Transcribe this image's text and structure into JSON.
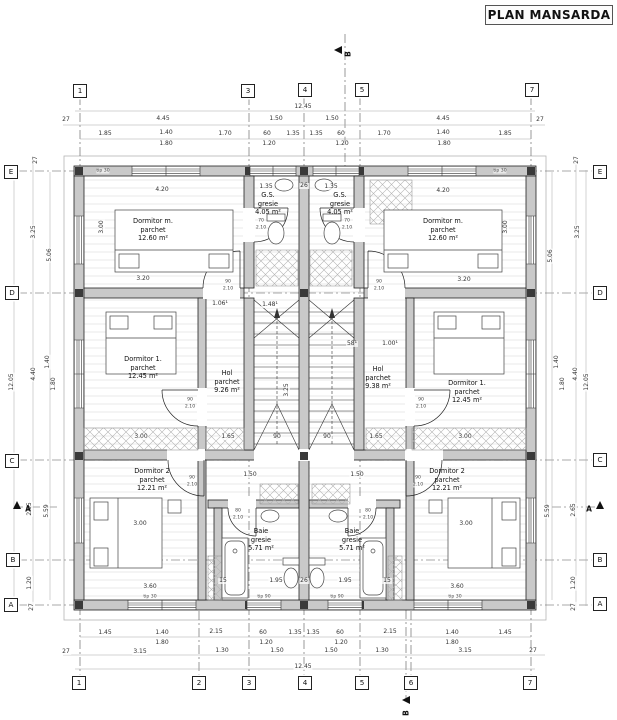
{
  "title": "PLAN MANSARDA",
  "colors": {
    "wall_fill": "#c9c9c9",
    "line": "#222222",
    "dim_line": "#999999",
    "grid_line": "#555555"
  },
  "rooms": [
    {
      "name": "Dormitor m.",
      "finish": "parchet",
      "area": "12.60 m²",
      "x": 153,
      "y": 222
    },
    {
      "name": "Dormitor m.",
      "finish": "parchet",
      "area": "12.60 m²",
      "x": 443,
      "y": 222
    },
    {
      "name": "G.S.",
      "finish": "gresie",
      "area": "4.05 m²",
      "x": 268,
      "y": 196
    },
    {
      "name": "G.S.",
      "finish": "gresie",
      "area": "4.05 m²",
      "x": 340,
      "y": 196
    },
    {
      "name": "Dormitor 1.",
      "finish": "parchet",
      "area": "12.45 m²",
      "x": 143,
      "y": 360
    },
    {
      "name": "Dormitor 1.",
      "finish": "parchet",
      "area": "12.45 m²",
      "x": 467,
      "y": 384
    },
    {
      "name": "Hol",
      "finish": "parchet",
      "area": "9.26 m²",
      "x": 227,
      "y": 374
    },
    {
      "name": "Hol",
      "finish": "parchet",
      "area": "9.38 m²",
      "x": 378,
      "y": 370
    },
    {
      "name": "Dormitor 2",
      "finish": "parchet",
      "area": "12.21 m²",
      "x": 152,
      "y": 472
    },
    {
      "name": "Dormitor 2",
      "finish": "parchet",
      "area": "12.21 m²",
      "x": 447,
      "y": 472
    },
    {
      "name": "Baie",
      "finish": "gresie",
      "area": "5.71 m²",
      "x": 261,
      "y": 532
    },
    {
      "name": "Baie",
      "finish": "gresie",
      "area": "5.71 m²",
      "x": 352,
      "y": 532
    }
  ],
  "grid_bubbles": [
    {
      "label": "1",
      "x": 80,
      "y": 91
    },
    {
      "label": "3",
      "x": 248,
      "y": 91
    },
    {
      "label": "4",
      "x": 305,
      "y": 90
    },
    {
      "label": "5",
      "x": 362,
      "y": 90
    },
    {
      "label": "7",
      "x": 532,
      "y": 90
    },
    {
      "label": "1",
      "x": 79,
      "y": 683
    },
    {
      "label": "2",
      "x": 199,
      "y": 683
    },
    {
      "label": "3",
      "x": 249,
      "y": 683
    },
    {
      "label": "4",
      "x": 305,
      "y": 683
    },
    {
      "label": "5",
      "x": 362,
      "y": 683
    },
    {
      "label": "6",
      "x": 411,
      "y": 683
    },
    {
      "label": "7",
      "x": 530,
      "y": 683
    },
    {
      "label": "E",
      "x": 11,
      "y": 172
    },
    {
      "label": "D",
      "x": 12,
      "y": 293
    },
    {
      "label": "C",
      "x": 12,
      "y": 461
    },
    {
      "label": "B",
      "x": 13,
      "y": 560
    },
    {
      "label": "A",
      "x": 11,
      "y": 605
    },
    {
      "label": "E",
      "x": 600,
      "y": 172
    },
    {
      "label": "D",
      "x": 600,
      "y": 293
    },
    {
      "label": "C",
      "x": 600,
      "y": 460
    },
    {
      "label": "B",
      "x": 600,
      "y": 560
    },
    {
      "label": "A",
      "x": 600,
      "y": 604
    }
  ],
  "section_markers": [
    {
      "label": "B",
      "tx": 338,
      "ty": 50,
      "dir": "left",
      "lx": 348,
      "ly": 54,
      "rot": 1
    },
    {
      "label": "B",
      "tx": 406,
      "ty": 700,
      "dir": "left",
      "lx": 406,
      "ly": 713,
      "rot": 1
    },
    {
      "label": "A",
      "tx": 17,
      "ty": 505,
      "dir": "up",
      "lx": 28,
      "ly": 509,
      "rot": 0
    },
    {
      "label": "A",
      "tx": 600,
      "ty": 505,
      "dir": "up",
      "lx": 589,
      "ly": 509,
      "rot": 0
    }
  ],
  "dim_labels": [
    {
      "t": "12.45",
      "x": 303,
      "y": 107
    },
    {
      "t": "27",
      "x": 66,
      "y": 120
    },
    {
      "t": "4.45",
      "x": 163,
      "y": 119
    },
    {
      "t": "1.50",
      "x": 276,
      "y": 119
    },
    {
      "t": "1.50",
      "x": 332,
      "y": 119
    },
    {
      "t": "4.45",
      "x": 443,
      "y": 119
    },
    {
      "t": "27",
      "x": 540,
      "y": 120
    },
    {
      "t": "1.85",
      "x": 105,
      "y": 134
    },
    {
      "t": "1.40",
      "x": 166,
      "y": 133
    },
    {
      "t": "1.70",
      "x": 225,
      "y": 134
    },
    {
      "t": "60",
      "x": 267,
      "y": 134
    },
    {
      "t": "1.35",
      "x": 293,
      "y": 134
    },
    {
      "t": "1.35",
      "x": 316,
      "y": 134
    },
    {
      "t": "60",
      "x": 341,
      "y": 134
    },
    {
      "t": "1.70",
      "x": 384,
      "y": 134
    },
    {
      "t": "1.40",
      "x": 443,
      "y": 133
    },
    {
      "t": "1.85",
      "x": 505,
      "y": 134
    },
    {
      "t": "1.80",
      "x": 166,
      "y": 144
    },
    {
      "t": "1.20",
      "x": 269,
      "y": 144
    },
    {
      "t": "1.20",
      "x": 342,
      "y": 144
    },
    {
      "t": "1.80",
      "x": 444,
      "y": 144
    },
    {
      "t": "1.45",
      "x": 105,
      "y": 633
    },
    {
      "t": "1.40",
      "x": 162,
      "y": 633
    },
    {
      "t": "2.15",
      "x": 216,
      "y": 632
    },
    {
      "t": "60",
      "x": 263,
      "y": 633
    },
    {
      "t": "1.35",
      "x": 295,
      "y": 633
    },
    {
      "t": "1.35",
      "x": 313,
      "y": 633
    },
    {
      "t": "60",
      "x": 340,
      "y": 633
    },
    {
      "t": "2.15",
      "x": 390,
      "y": 632
    },
    {
      "t": "1.40",
      "x": 452,
      "y": 633
    },
    {
      "t": "1.45",
      "x": 505,
      "y": 633
    },
    {
      "t": "1.80",
      "x": 162,
      "y": 643
    },
    {
      "t": "1.20",
      "x": 266,
      "y": 643
    },
    {
      "t": "1.20",
      "x": 341,
      "y": 643
    },
    {
      "t": "1.80",
      "x": 452,
      "y": 643
    },
    {
      "t": "27",
      "x": 66,
      "y": 652
    },
    {
      "t": "3.15",
      "x": 140,
      "y": 652
    },
    {
      "t": "1.30",
      "x": 222,
      "y": 651
    },
    {
      "t": "1.50",
      "x": 277,
      "y": 651
    },
    {
      "t": "1.50",
      "x": 331,
      "y": 651
    },
    {
      "t": "1.30",
      "x": 382,
      "y": 651
    },
    {
      "t": "3.15",
      "x": 465,
      "y": 651
    },
    {
      "t": "27",
      "x": 533,
      "y": 651
    },
    {
      "t": "12.45",
      "x": 303,
      "y": 667
    },
    {
      "t": "27",
      "x": 36,
      "y": 160,
      "r": 1
    },
    {
      "t": "3.25",
      "x": 34,
      "y": 232,
      "r": 1
    },
    {
      "t": "5.06",
      "x": 50,
      "y": 255,
      "r": 1
    },
    {
      "t": "4.40",
      "x": 34,
      "y": 374,
      "r": 1
    },
    {
      "t": "1.40",
      "x": 48,
      "y": 362,
      "r": 1
    },
    {
      "t": "1.80",
      "x": 54,
      "y": 384,
      "r": 1
    },
    {
      "t": "12.05",
      "x": 12,
      "y": 382,
      "r": 1
    },
    {
      "t": "2.65",
      "x": 30,
      "y": 509,
      "r": 1
    },
    {
      "t": "5.59",
      "x": 47,
      "y": 511,
      "r": 1
    },
    {
      "t": "1.20",
      "x": 30,
      "y": 583,
      "r": 1
    },
    {
      "t": "27",
      "x": 32,
      "y": 607,
      "r": 1
    },
    {
      "t": "27",
      "x": 577,
      "y": 160,
      "r": 1
    },
    {
      "t": "3.25",
      "x": 578,
      "y": 232,
      "r": 1
    },
    {
      "t": "5.06",
      "x": 551,
      "y": 256,
      "r": 1
    },
    {
      "t": "4.40",
      "x": 576,
      "y": 374,
      "r": 1
    },
    {
      "t": "1.40",
      "x": 557,
      "y": 362,
      "r": 1
    },
    {
      "t": "1.80",
      "x": 563,
      "y": 384,
      "r": 1
    },
    {
      "t": "12.05",
      "x": 587,
      "y": 382,
      "r": 1
    },
    {
      "t": "2.65",
      "x": 574,
      "y": 510,
      "r": 1
    },
    {
      "t": "5.59",
      "x": 548,
      "y": 511,
      "r": 1
    },
    {
      "t": "1.20",
      "x": 574,
      "y": 583,
      "r": 1
    },
    {
      "t": "27",
      "x": 574,
      "y": 607,
      "r": 1
    },
    {
      "t": "4.20",
      "x": 162,
      "y": 190
    },
    {
      "t": "4.20",
      "x": 443,
      "y": 191
    },
    {
      "t": "3.00",
      "x": 102,
      "y": 227,
      "r": 1
    },
    {
      "t": "3.00",
      "x": 506,
      "y": 227,
      "r": 1
    },
    {
      "t": "3.20",
      "x": 143,
      "y": 279
    },
    {
      "t": "3.20",
      "x": 464,
      "y": 280
    },
    {
      "t": "1.35",
      "x": 266,
      "y": 187
    },
    {
      "t": "26",
      "x": 304,
      "y": 186
    },
    {
      "t": "1.35",
      "x": 331,
      "y": 187
    },
    {
      "t": "1.06¹",
      "x": 220,
      "y": 304
    },
    {
      "t": "1.48¹",
      "x": 270,
      "y": 305
    },
    {
      "t": "58¹",
      "x": 352,
      "y": 344
    },
    {
      "t": "1.00¹",
      "x": 390,
      "y": 344
    },
    {
      "t": "3.25",
      "x": 287,
      "y": 390,
      "r": 1
    },
    {
      "t": "3.00",
      "x": 141,
      "y": 437
    },
    {
      "t": "1.65",
      "x": 228,
      "y": 437
    },
    {
      "t": "90",
      "x": 277,
      "y": 437
    },
    {
      "t": "90",
      "x": 327,
      "y": 437
    },
    {
      "t": "1.65",
      "x": 376,
      "y": 437
    },
    {
      "t": "3.00",
      "x": 465,
      "y": 437
    },
    {
      "t": "1.50",
      "x": 250,
      "y": 475
    },
    {
      "t": "1.50",
      "x": 357,
      "y": 475
    },
    {
      "t": "3.00",
      "x": 140,
      "y": 524
    },
    {
      "t": "3.00",
      "x": 466,
      "y": 524
    },
    {
      "t": "3.60",
      "x": 150,
      "y": 587
    },
    {
      "t": "3.60",
      "x": 457,
      "y": 587
    },
    {
      "t": "15",
      "x": 223,
      "y": 581
    },
    {
      "t": "1.95",
      "x": 276,
      "y": 581
    },
    {
      "t": "26",
      "x": 304,
      "y": 581
    },
    {
      "t": "1.95",
      "x": 345,
      "y": 581
    },
    {
      "t": "15",
      "x": 387,
      "y": 581
    }
  ],
  "tiny_labels": [
    {
      "t": "90",
      "x": 228,
      "y": 282
    },
    {
      "t": "2.10",
      "x": 228,
      "y": 289
    },
    {
      "t": "90",
      "x": 379,
      "y": 282
    },
    {
      "t": "2.10",
      "x": 379,
      "y": 289
    },
    {
      "t": "70",
      "x": 261,
      "y": 221
    },
    {
      "t": "2.10",
      "x": 261,
      "y": 228
    },
    {
      "t": "70",
      "x": 347,
      "y": 221
    },
    {
      "t": "2.10",
      "x": 347,
      "y": 228
    },
    {
      "t": "90",
      "x": 190,
      "y": 400
    },
    {
      "t": "2.10",
      "x": 190,
      "y": 407
    },
    {
      "t": "90",
      "x": 421,
      "y": 400
    },
    {
      "t": "2.10",
      "x": 421,
      "y": 407
    },
    {
      "t": "90",
      "x": 192,
      "y": 478
    },
    {
      "t": "2.10",
      "x": 192,
      "y": 485
    },
    {
      "t": "90",
      "x": 418,
      "y": 478
    },
    {
      "t": "2.10",
      "x": 418,
      "y": 485
    },
    {
      "t": "80",
      "x": 238,
      "y": 511
    },
    {
      "t": "2.10",
      "x": 238,
      "y": 518
    },
    {
      "t": "80",
      "x": 368,
      "y": 511
    },
    {
      "t": "2.10",
      "x": 368,
      "y": 518
    },
    {
      "t": "tip 30",
      "x": 103,
      "y": 171
    },
    {
      "t": "tip 30",
      "x": 500,
      "y": 171
    },
    {
      "t": "tip 30",
      "x": 150,
      "y": 597
    },
    {
      "t": "tip 30",
      "x": 455,
      "y": 597
    },
    {
      "t": "tip 90",
      "x": 264,
      "y": 597
    },
    {
      "t": "tip 90",
      "x": 337,
      "y": 597
    }
  ]
}
